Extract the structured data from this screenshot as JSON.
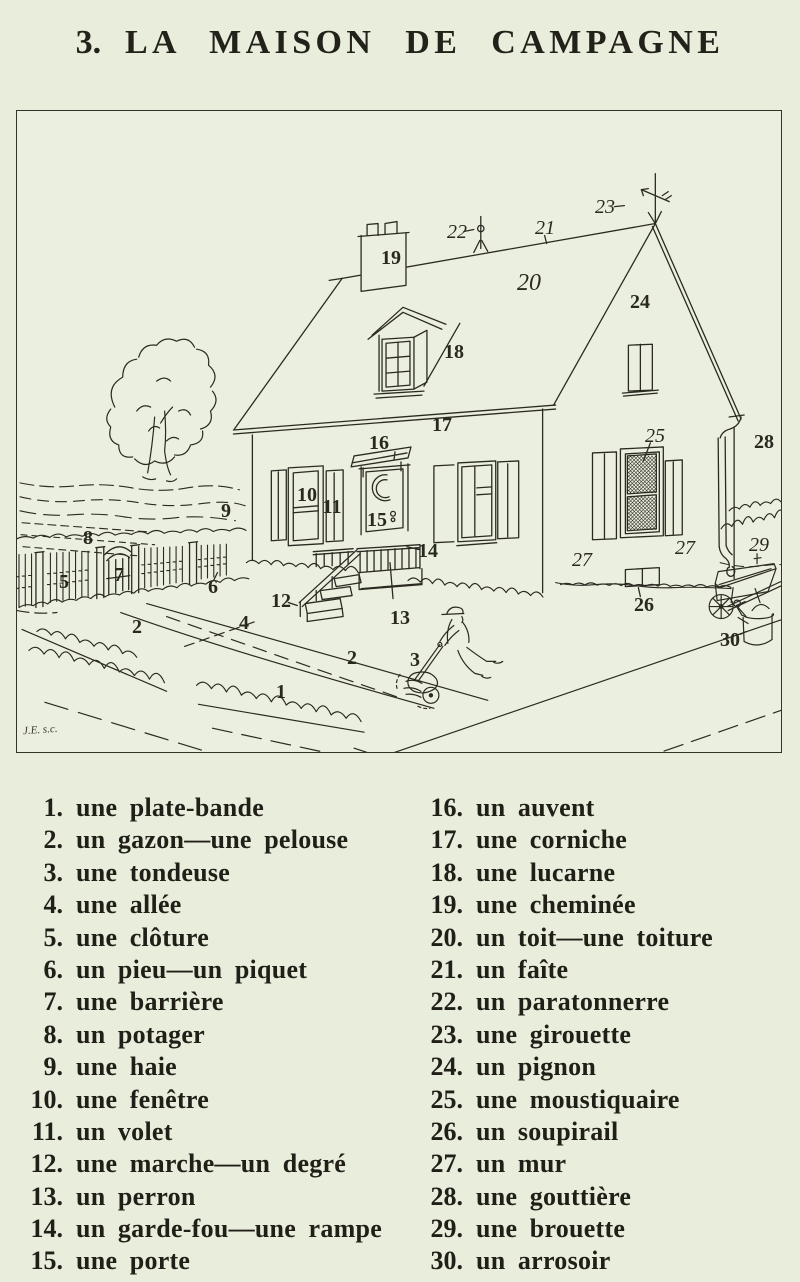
{
  "page": {
    "title_number": "3.",
    "title_text": "LA MAISON DE CAMPAGNE",
    "signature": "J.E. s.c."
  },
  "colors": {
    "paper": "#e9eedc",
    "ink": "#2b2a22"
  },
  "vocab": {
    "left": [
      {
        "num": "1.",
        "term": "une plate-bande"
      },
      {
        "num": "2.",
        "term": "un gazon—une pelouse"
      },
      {
        "num": "3.",
        "term": "une tondeuse"
      },
      {
        "num": "4.",
        "term": "une allée"
      },
      {
        "num": "5.",
        "term": "une clôture"
      },
      {
        "num": "6.",
        "term": "un pieu—un piquet"
      },
      {
        "num": "7.",
        "term": "une barrière"
      },
      {
        "num": "8.",
        "term": "un potager"
      },
      {
        "num": "9.",
        "term": "une haie"
      },
      {
        "num": "10.",
        "term": "une fenêtre"
      },
      {
        "num": "11.",
        "term": "un volet"
      },
      {
        "num": "12.",
        "term": "une marche—un degré"
      },
      {
        "num": "13.",
        "term": "un perron"
      },
      {
        "num": "14.",
        "term": "un garde-fou—une rampe"
      },
      {
        "num": "15.",
        "term": "une porte"
      }
    ],
    "right": [
      {
        "num": "16.",
        "term": "un auvent"
      },
      {
        "num": "17.",
        "term": "une corniche"
      },
      {
        "num": "18.",
        "term": "une lucarne"
      },
      {
        "num": "19.",
        "term": "une cheminée"
      },
      {
        "num": "20.",
        "term": "un toit—une toiture"
      },
      {
        "num": "21.",
        "term": "un faîte"
      },
      {
        "num": "22.",
        "term": "un paratonnerre"
      },
      {
        "num": "23.",
        "term": "une girouette"
      },
      {
        "num": "24.",
        "term": "un pignon"
      },
      {
        "num": "25.",
        "term": "une moustiquaire"
      },
      {
        "num": "26.",
        "term": "un soupirail"
      },
      {
        "num": "27.",
        "term": "un mur"
      },
      {
        "num": "28.",
        "term": "une gouttière"
      },
      {
        "num": "29.",
        "term": "une brouette"
      },
      {
        "num": "30.",
        "term": "un arrosoir"
      }
    ]
  },
  "figure": {
    "labels": [
      {
        "n": "1",
        "x": 264,
        "y": 581
      },
      {
        "n": "2",
        "x": 120,
        "y": 516
      },
      {
        "n": "2",
        "x": 335,
        "y": 547
      },
      {
        "n": "3",
        "x": 398,
        "y": 549
      },
      {
        "n": "4",
        "x": 227,
        "y": 512
      },
      {
        "n": "5",
        "x": 47,
        "y": 471
      },
      {
        "n": "6",
        "x": 196,
        "y": 476
      },
      {
        "n": "7",
        "x": 102,
        "y": 464
      },
      {
        "n": "8",
        "x": 71,
        "y": 427
      },
      {
        "n": "9",
        "x": 209,
        "y": 400
      },
      {
        "n": "10",
        "x": 290,
        "y": 384
      },
      {
        "n": "11",
        "x": 315,
        "y": 396
      },
      {
        "n": "12",
        "x": 264,
        "y": 490
      },
      {
        "n": "13",
        "x": 383,
        "y": 507
      },
      {
        "n": "14",
        "x": 411,
        "y": 440
      },
      {
        "n": "15",
        "x": 360,
        "y": 409
      },
      {
        "n": "16",
        "x": 362,
        "y": 332
      },
      {
        "n": "17",
        "x": 425,
        "y": 314
      },
      {
        "n": "18",
        "x": 437,
        "y": 241
      },
      {
        "n": "19",
        "x": 374,
        "y": 147
      },
      {
        "n": "20",
        "x": 512,
        "y": 172,
        "i": 1,
        "s": 24
      },
      {
        "n": "21",
        "x": 528,
        "y": 117,
        "i": 1
      },
      {
        "n": "22",
        "x": 440,
        "y": 121,
        "i": 1
      },
      {
        "n": "23",
        "x": 588,
        "y": 96,
        "i": 1
      },
      {
        "n": "24",
        "x": 623,
        "y": 191
      },
      {
        "n": "25",
        "x": 638,
        "y": 325,
        "i": 1
      },
      {
        "n": "26",
        "x": 627,
        "y": 494
      },
      {
        "n": "27",
        "x": 565,
        "y": 449,
        "i": 1
      },
      {
        "n": "27",
        "x": 668,
        "y": 437,
        "i": 1
      },
      {
        "n": "28",
        "x": 747,
        "y": 331
      },
      {
        "n": "29",
        "x": 742,
        "y": 434,
        "i": 1
      },
      {
        "n": "30",
        "x": 713,
        "y": 529
      }
    ]
  }
}
